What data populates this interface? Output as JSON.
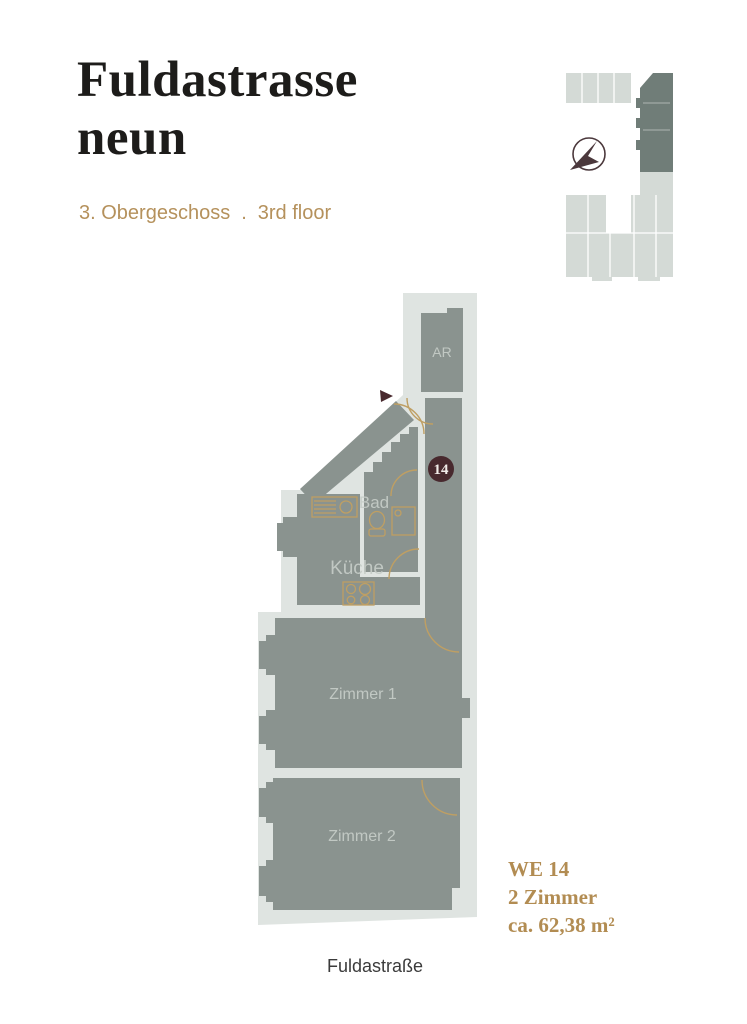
{
  "header": {
    "title_line1": "Fuldastrasse",
    "title_line2": "neun",
    "floor_label_de": "3. Obergeschoss",
    "separator": ".",
    "floor_label_en": "3rd floor"
  },
  "minimap": {
    "base_color": "#d4dad6",
    "highlight_color": "#707d78",
    "compass_color": "#4b383c"
  },
  "floorplan": {
    "rooms": [
      {
        "id": "ar",
        "label": "AR"
      },
      {
        "id": "bad",
        "label": "Bad"
      },
      {
        "id": "kueche",
        "label": "Küche"
      },
      {
        "id": "zimmer1",
        "label": "Zimmer 1"
      },
      {
        "id": "zimmer2",
        "label": "Zimmer 2"
      }
    ],
    "unit_badge": "14",
    "colors": {
      "room_fill": "#8a938f",
      "footprint": "#dfe4e1",
      "door_arc": "#bf9f63",
      "badge": "#48292e",
      "label_text": "#c6cdc8"
    }
  },
  "unit_info": {
    "line1": "WE 14",
    "line2": "2 Zimmer",
    "line3": "ca. 62,38 m²",
    "color": "#b28c52"
  },
  "street": {
    "label": "Fuldastraße"
  }
}
